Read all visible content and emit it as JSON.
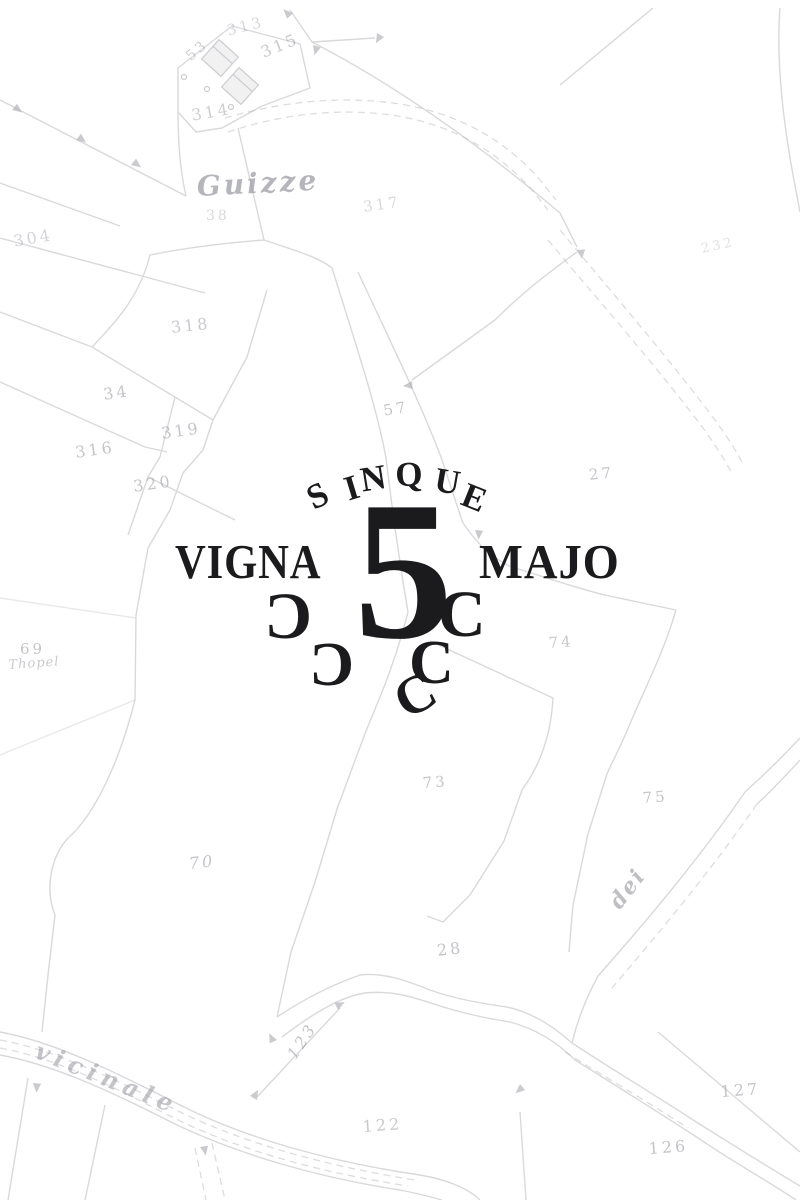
{
  "title": "Vigna 5 Majo — historic cadastral map with wine-estate logo",
  "colors": {
    "ink": "#1b1b1d",
    "map_line": "#b4b4ba",
    "map_label": "#9d9da6",
    "background": "#ffffff"
  },
  "logo": {
    "arc_word": "SINQUE",
    "arc_letters": [
      "S",
      "I",
      "N",
      "Q",
      "U",
      "E"
    ],
    "left_word": "VIGNA",
    "numeral": "5",
    "right_word": "MAJO",
    "grape_glyphs": [
      "C",
      "C",
      "C",
      "C",
      "C"
    ]
  },
  "map": {
    "labels": [
      {
        "text": "313"
      },
      {
        "text": "53"
      },
      {
        "text": "315"
      },
      {
        "text": "314"
      },
      {
        "text": "Guizze"
      },
      {
        "text": "38"
      },
      {
        "text": "317"
      },
      {
        "text": "304"
      },
      {
        "text": "318"
      },
      {
        "text": "34"
      },
      {
        "text": "319"
      },
      {
        "text": "316"
      },
      {
        "text": "320"
      },
      {
        "text": "57"
      },
      {
        "text": "27"
      },
      {
        "text": "69"
      },
      {
        "text": "Thopel"
      },
      {
        "text": "74"
      },
      {
        "text": "73"
      },
      {
        "text": "75"
      },
      {
        "text": "70"
      },
      {
        "text": "dei"
      },
      {
        "text": "28"
      },
      {
        "text": "vicinale"
      },
      {
        "text": "123"
      },
      {
        "text": "122"
      },
      {
        "text": "126"
      },
      {
        "text": "127"
      },
      {
        "text": "232"
      }
    ]
  }
}
